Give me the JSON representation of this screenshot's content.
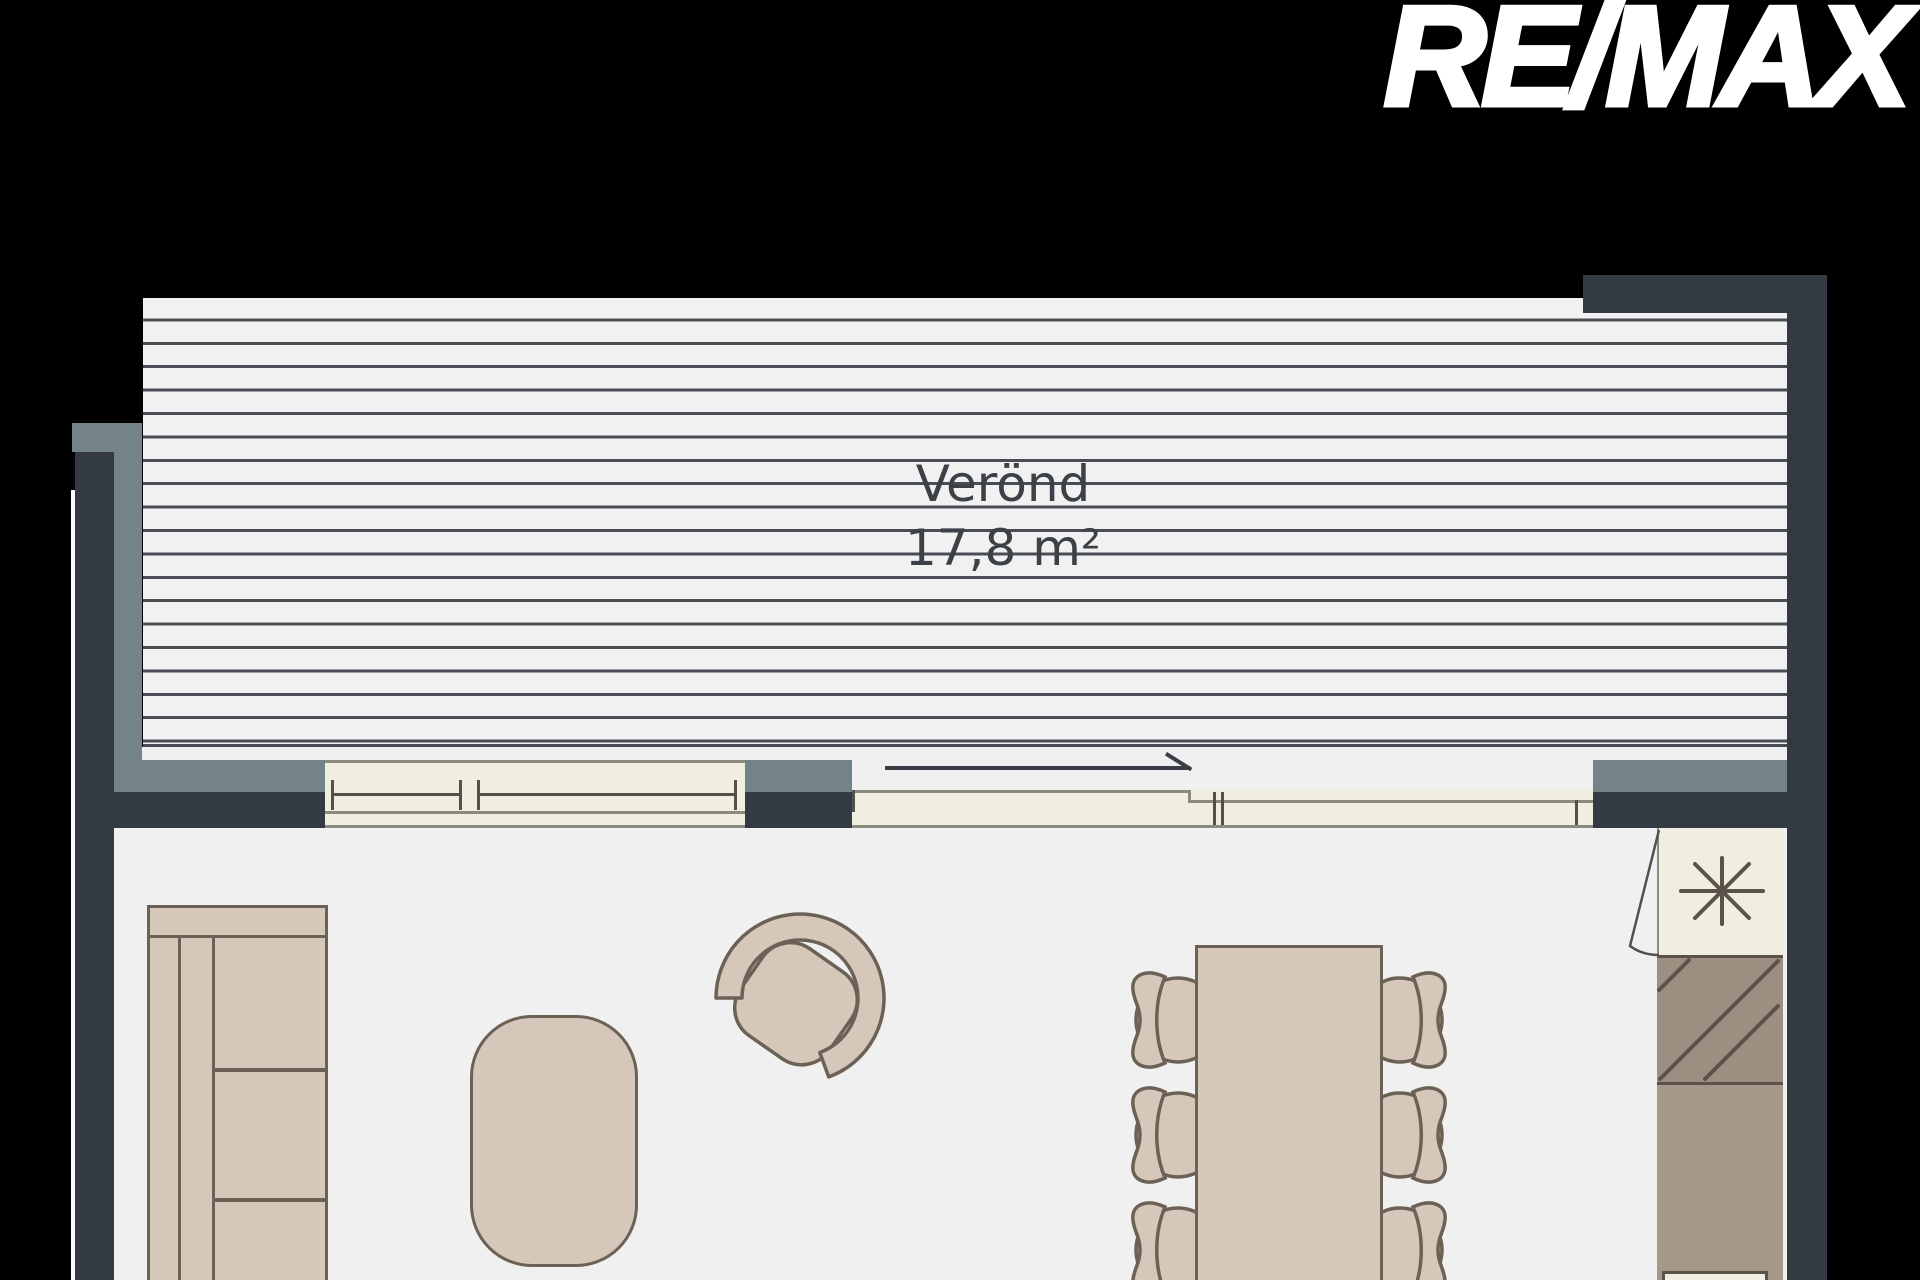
{
  "branding": {
    "logo_text": "RE/MAX"
  },
  "veranda": {
    "label": "Verönd",
    "area": "17,8 m²"
  },
  "elements": {
    "deck": "veranda-decking",
    "walls": [
      "left-exterior-wall",
      "left-railing",
      "bottom-left-wall",
      "window-pillar",
      "top-right-wall",
      "right-exterior-wall"
    ],
    "openings": [
      "double-window",
      "sliding-door",
      "interior-door"
    ],
    "furniture": [
      "sofa",
      "coffee-table",
      "armchair",
      "dining-table",
      "dining-chair-x6"
    ],
    "kitchen": [
      "cooktop-burner-icon",
      "hatched-counter",
      "counter",
      "sink"
    ]
  },
  "colors": {
    "background": "#000000",
    "wall_dark": "#343a42",
    "wall_gray": "#74828a",
    "deck_bg": "#f1f1f2",
    "deck_line": "#4a4e54",
    "floor": "#f0f0f1",
    "window_cream": "#f0eee0",
    "window_line": "#8c897f",
    "window_tick": "#55504a",
    "furniture_fill": "#d5c8bb",
    "furniture_line": "#6b6154",
    "hatch_fill": "#9c8f82",
    "counter_fill": "#a49889",
    "kitchen_line": "#5b5349",
    "label_text": "#3c4147",
    "logo_text_color": "#ffffff"
  }
}
